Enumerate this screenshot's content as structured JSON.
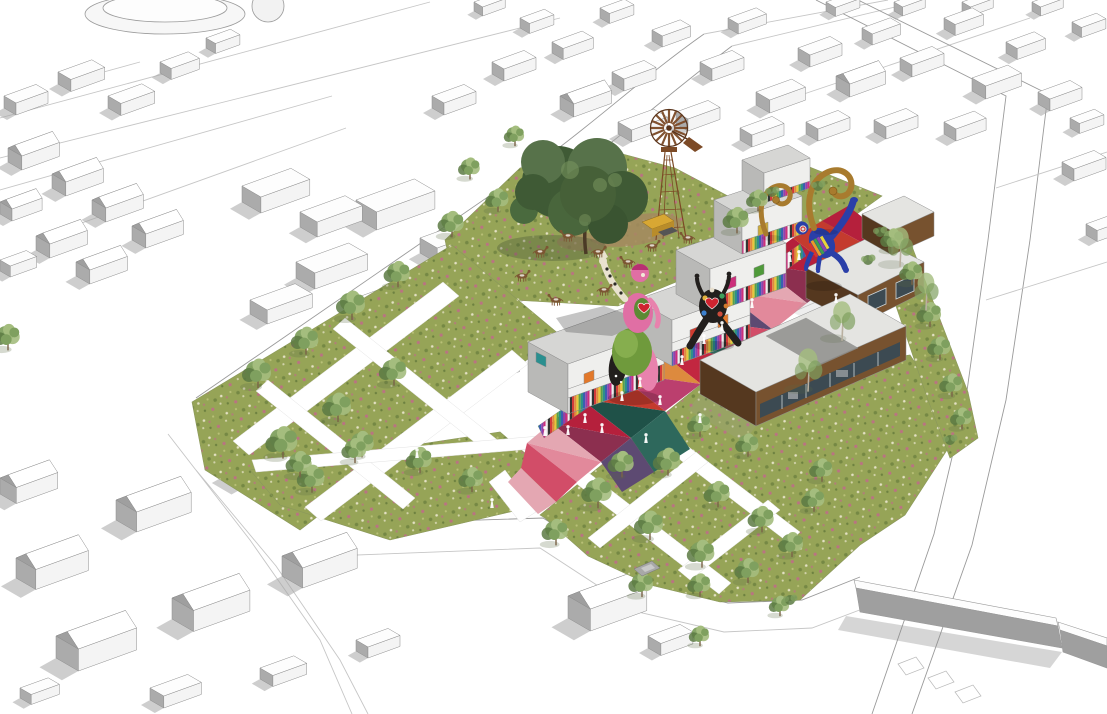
{
  "scene": {
    "title": "Aerial perspective rendering of a neighbourhood block redevelopment",
    "description": "Bird's-eye architectural collage: white sketch-style massing of the surrounding town frames a landscaped site with flowering meadows, white path grids, street trees, grey container studios with multicoloured striped bases, a diagonal promenade paved in red, pink, orange, teal and purple triangles, giant colourful Nana sculptures, golden horn sculptures, a rusty lattice windmill, grazing ponies, timber-and-glass pavilions, parking courts and a perimeter wall along the main road.",
    "elements": [
      "context-massing",
      "streets",
      "flower-meadow",
      "path-network",
      "colour-promenade",
      "container-studios",
      "timber-pavilions",
      "windmill",
      "heritage-tree",
      "nana-sculpture",
      "heart-sculpture",
      "acrobat-sculpture",
      "horn-sculptures",
      "grazing-ponies",
      "pedestrians",
      "parking-court",
      "perimeter-wall",
      "street-trees"
    ],
    "counts": {
      "pedestrians": 18,
      "ponies": 9,
      "sculptures": 4
    }
  },
  "palette": {
    "background": "#ffffff",
    "line": "#9a9a9a",
    "line_light": "#c6c6c6",
    "massing_top": "#fdfdfd",
    "massing_front": "#f4f4f4",
    "massing_side": "#ababab",
    "massing_shadow": "#a6a6a6",
    "meadow_base": "#96a457",
    "meadow_dark": "#6d8140",
    "flower_pink": "#c2688c",
    "flower_white": "#ece7cf",
    "tree_light": "#a4bd7e",
    "tree_mid": "#7fa05f",
    "tree_dark": "#5c7a43",
    "trunk": "#7a6348",
    "big_tree_dark": "#3f5a35",
    "big_tree_mid": "#57724a",
    "big_tree_light": "#7e9a62",
    "dirt": "#a58a5f",
    "windmill_rust": "#7c4a26",
    "windmill_dark": "#59331a",
    "machine_yellow": "#d8a733",
    "roof_grey": "#e4e4e1",
    "roof_dark": "#8f8f8c",
    "container_top": "#d6d6d4",
    "container_front": "#efefed",
    "container_side": "#b9b9b7",
    "wood": "#77522f",
    "wood_dark": "#55381f",
    "glass": "#3c4a52",
    "glass_light": "#cfd6d9",
    "gold": "#a87b2e",
    "sculpture_pink": "#e06fa4",
    "sculpture_pink_dark": "#b82f72",
    "sculpture_green": "#6f9a3c",
    "sculpture_blue": "#2a3fa8",
    "sculpture_black": "#221f1d",
    "people": "#ffffff",
    "pony_brown": "#7c5633",
    "pony_white": "#e9e4da",
    "car_grey": "#a8a8a8",
    "wall_grey": "#9f9f9f",
    "plaza": [
      "#b5203c",
      "#d24d68",
      "#c43b2e",
      "#e2899b",
      "#dd8a3e",
      "#8c2f4f",
      "#2e685c",
      "#1f5148",
      "#5d4a72",
      "#bb3f6e",
      "#e4a7b2",
      "#c22740"
    ],
    "stripes": [
      "#d23b3b",
      "#e08a3e",
      "#e6c83c",
      "#58a04a",
      "#2e8f8a",
      "#3b5fb0",
      "#8e44ad",
      "#cc2f7b",
      "#efefef",
      "#333333"
    ],
    "panels": [
      "#e2782a",
      "#cc2f7b",
      "#4f9a3a",
      "#2a8f8f",
      "#cf3b2f",
      "#caa93a"
    ]
  }
}
